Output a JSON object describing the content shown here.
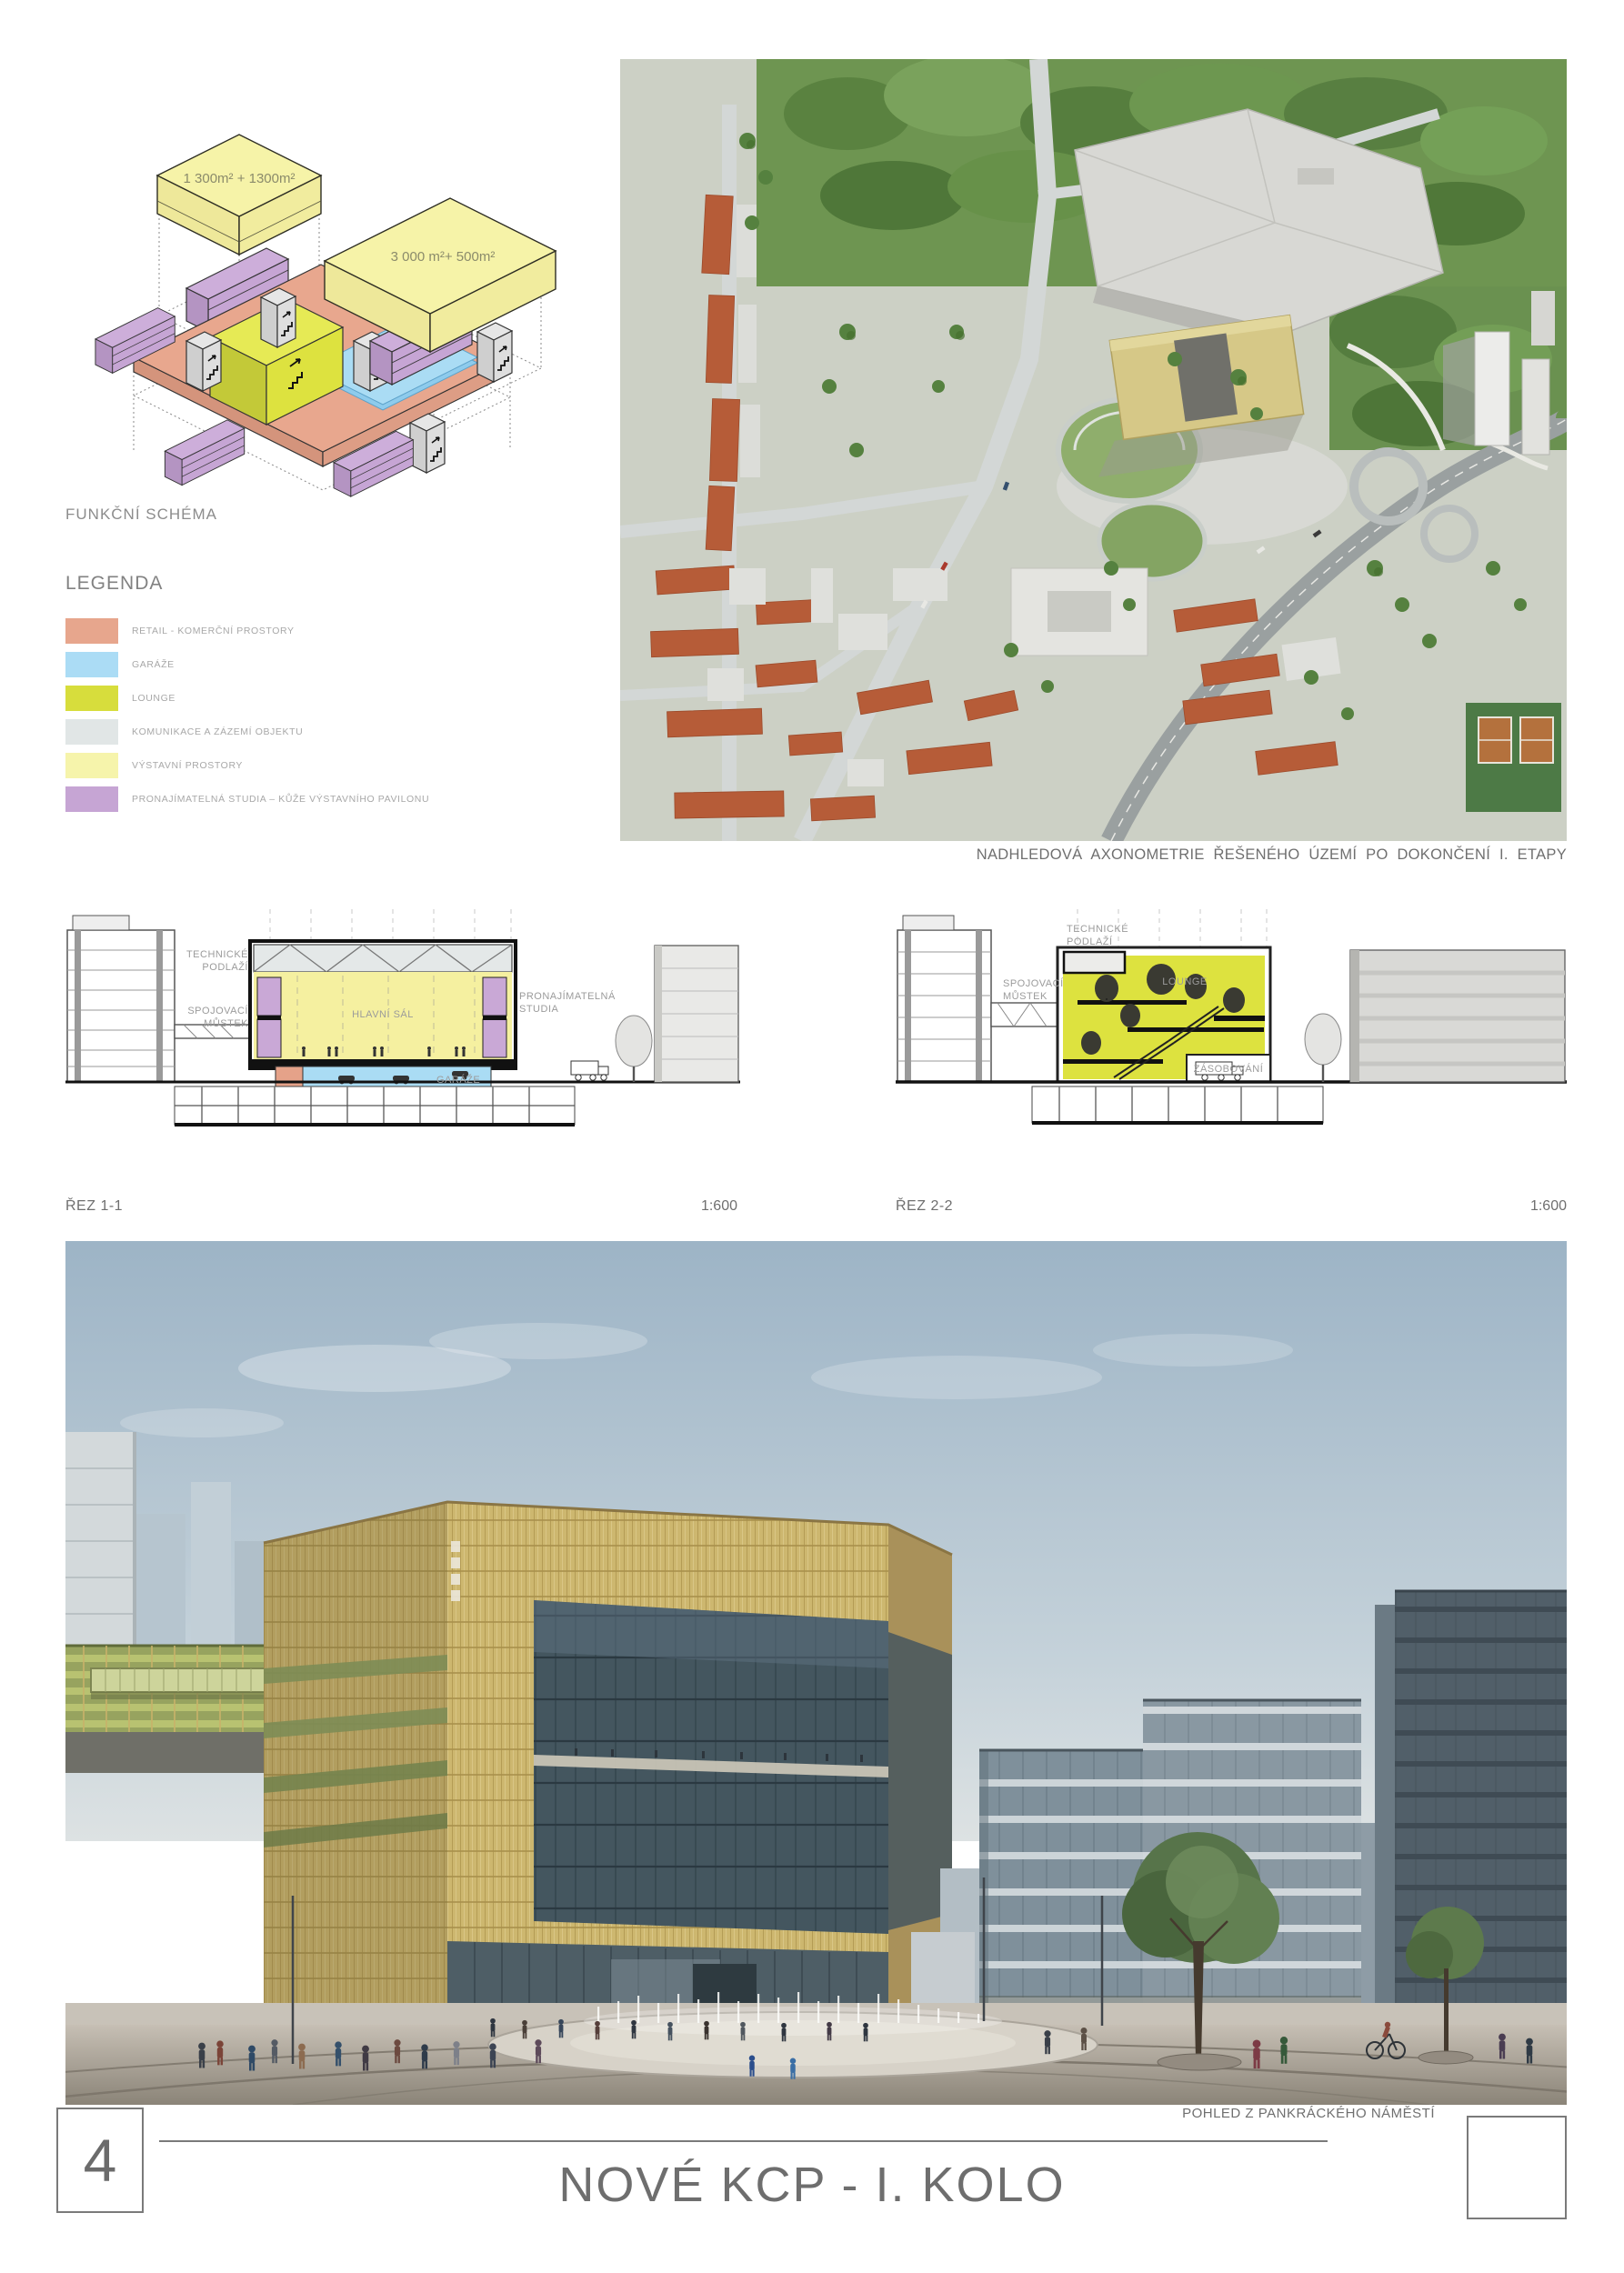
{
  "board": {
    "page_number": "4",
    "title": "NOVÉ KCP - I. KOLO"
  },
  "schema": {
    "title": "FUNKČNÍ SCHÉMA",
    "box1_area_label": "1 300m² + 1300m²",
    "box2_area_label": "3 000 m²+ 500m²"
  },
  "legend": {
    "title": "LEGENDA",
    "items": [
      {
        "label": "RETAIL - KOMERČNÍ PROSTORY",
        "color": "#e7a68d"
      },
      {
        "label": "GARÁŽE",
        "color": "#abdcf5"
      },
      {
        "label": "LOUNGE",
        "color": "#d7dd3c"
      },
      {
        "label": "KOMUNIKACE A ZÁZEMÍ OBJEKTU",
        "color": "#e1e6e6"
      },
      {
        "label": "VÝSTAVNÍ PROSTORY",
        "color": "#f6f4ab"
      },
      {
        "label": "PRONAJÍMATELNÁ STUDIA – KŮŽE VÝSTAVNÍHO PAVILONU",
        "color": "#c6a5d4"
      }
    ]
  },
  "aerial": {
    "caption": "NADHLEDOVÁ AXONOMETRIE ŘEŠENÉHO ÚZEMÍ PO DOKONČENÍ I. ETAPY"
  },
  "sections": {
    "section1": {
      "name": "ŘEZ 1-1",
      "scale": "1:600",
      "labels": {
        "technicke_1": "TECHNICKÉ",
        "technicke_2": "PODLAŽÍ",
        "spojovaci_1": "SPOJOVACÍ",
        "spojovaci_2": "MŮSTEK",
        "hlavni_sal": "HLAVNÍ SÁL",
        "garaze": "GARÁŽE",
        "studia_1": "PRONAJÍMATELNÁ",
        "studia_2": "STUDIA"
      }
    },
    "section2": {
      "name": "ŘEZ 2-2",
      "scale": "1:600",
      "labels": {
        "technicke_1": "TECHNICKÉ",
        "technicke_2": "PODLAŽÍ",
        "spojovaci_1": "SPOJOVACÍ",
        "spojovaci_2": "MŮSTEK",
        "lounge": "LOUNGE",
        "zasobovani": "ZÁSOBOVÁNÍ"
      }
    }
  },
  "render": {
    "caption": "POHLED Z PANKRÁCKÉHO NÁMĚSTÍ"
  }
}
